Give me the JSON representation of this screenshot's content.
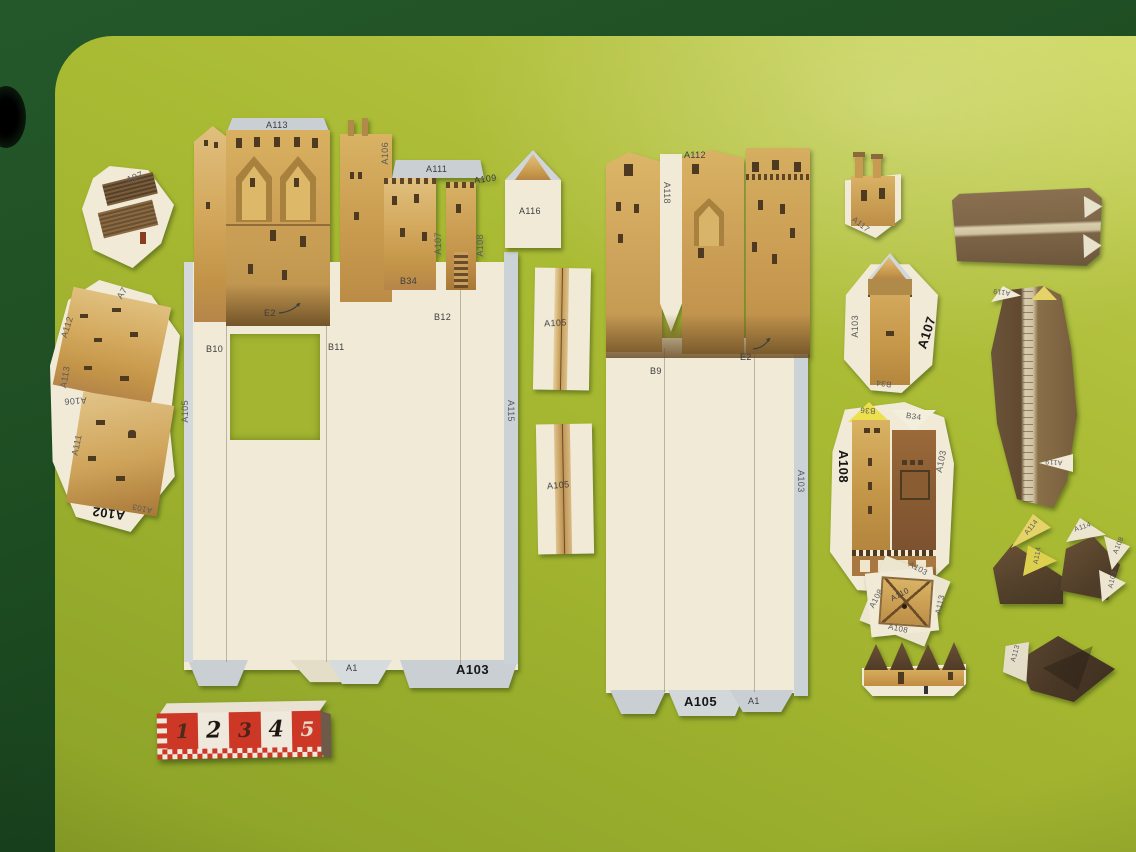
{
  "scene": {
    "description": "Photograph of uncut cardboard paper-model (papercraft) castle kit pieces — Palace of the Popes style walls, towers and roofs — laid out on a yellow-green cutting board over a dark green table, with a small red/white paper scale ruler.",
    "background_color": "#1e4d22",
    "board_color": "#a9ba33",
    "paper_color": "#f0ead6",
    "flap_color": "#c9cfd2",
    "wall_color": "#d3a85c",
    "roof_color": "#5c4732"
  },
  "ruler": {
    "numbers": [
      "1",
      "2",
      "3",
      "4",
      "5"
    ],
    "red": "#cc3726",
    "white": "#efe9dd"
  },
  "pieces": {
    "a97": {
      "label": "A97"
    },
    "wall_group_a102": {
      "tab_a7": "A7",
      "edge_a112": "A112",
      "edge_a113": "A113",
      "edge_a106": "A106",
      "edge_a111": "A111",
      "bold_a102": "A102",
      "small_a103": "A103"
    },
    "sheet1": {
      "label_a113": "A113",
      "tab_a106": "A106",
      "tab_a111": "A111",
      "tab_a109": "A109",
      "col_a107": "A107",
      "col_a108": "A108",
      "tab_b34": "B34",
      "tab_b12": "B12",
      "tab_b10": "B10",
      "tab_b11": "B11",
      "label_e2": "E2",
      "edge_a105": "A105",
      "edge_a115": "A115",
      "tab_a1": "A1",
      "bold_a103": "A103"
    },
    "a116": {
      "label": "A116"
    },
    "strip_a105_top": {
      "label": "A105"
    },
    "strip_a105_bottom": {
      "label": "A105"
    },
    "sheet2": {
      "tab_a112": "A112",
      "col_a118": "A118",
      "tab_b9": "B9",
      "label_e2": "E2",
      "bold_a105": "A105",
      "tab_a1": "A1",
      "edge_a103": "A103"
    },
    "a117": {
      "label": "A117"
    },
    "tower_a107": {
      "edge_a103": "A103",
      "bold_a107": "A107",
      "tab_b34": "B34"
    },
    "tower_a108": {
      "bold_a108": "A108",
      "tab_b36": "B36",
      "tab_b34": "B34",
      "edge_a103": "A103"
    },
    "pyramid_a110": {
      "center": "A110",
      "tab_left": "A108",
      "tab_top": "A103",
      "tab_right": "A113",
      "tab_bottom": "A108"
    },
    "roof_curved": {
      "tab_top": "A119",
      "tab_right": "A119"
    },
    "roof_yellow_tabs": {
      "tab1": "A114",
      "tab2": "A114"
    },
    "roof_white_tabs": {
      "tab1": "A114",
      "tab2": "A108",
      "tab3": "A103"
    },
    "roof_a113": {
      "tab": "A113"
    }
  }
}
